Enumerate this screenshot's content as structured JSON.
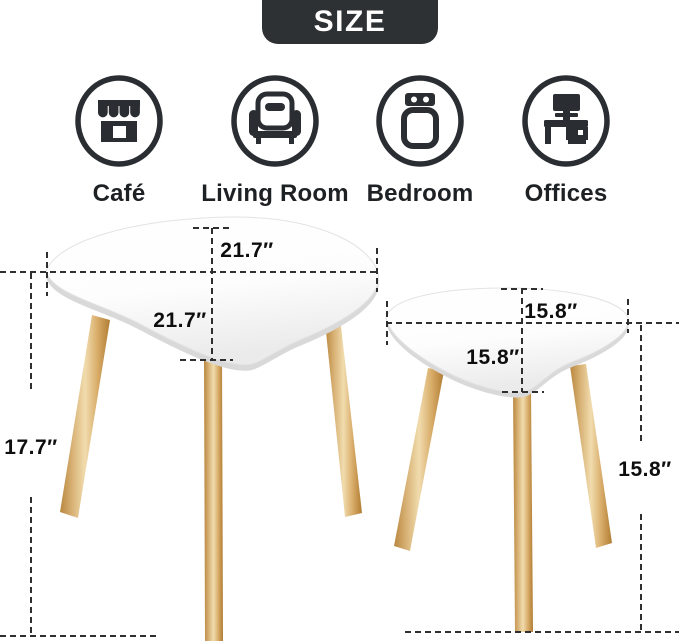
{
  "badge": {
    "label": "SIZE"
  },
  "use_cases": [
    {
      "label": "Café",
      "icon": "storefront-icon"
    },
    {
      "label": "Living Room",
      "icon": "armchair-icon"
    },
    {
      "label": "Bedroom",
      "icon": "bed-icon"
    },
    {
      "label": "Offices",
      "icon": "desk-icon"
    }
  ],
  "dimensions": {
    "large_table": {
      "width": "21.7″",
      "depth": "21.7″",
      "height": "17.7″"
    },
    "small_table": {
      "width": "15.8″",
      "depth": "15.8″",
      "height": "15.8″"
    }
  },
  "colors": {
    "badge_bg": "#2e3134",
    "icon_ink": "#2a2d31",
    "dash": "#2f2f2f",
    "tabletop": "#ffffff",
    "tabletop_edge": "#d9d9d9",
    "wood_light": "#f1dcae",
    "wood_dark": "#b07c33"
  }
}
